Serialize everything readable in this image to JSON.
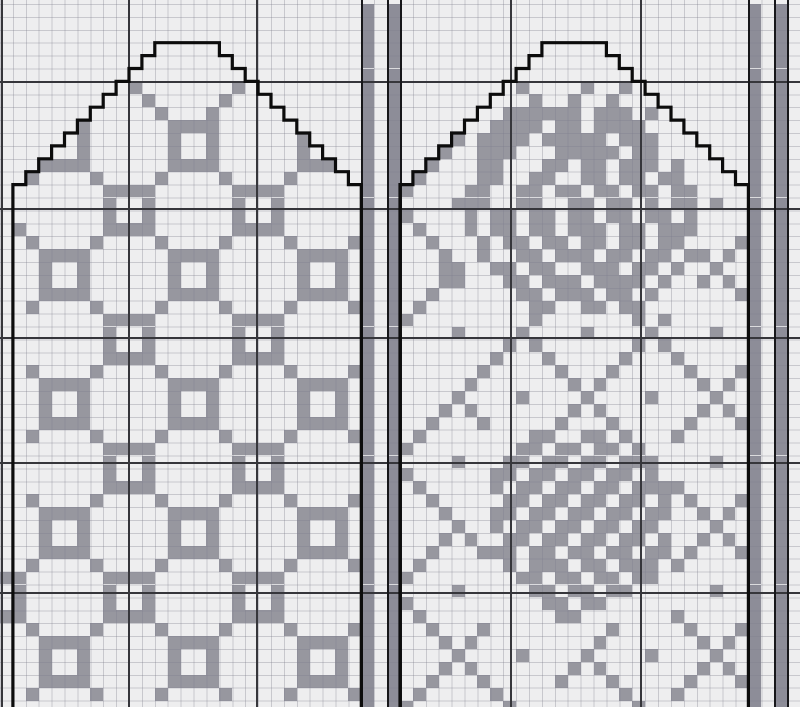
{
  "chart_data": {
    "type": "heatmap",
    "title": "Two-panel stranded-knitting mitten chart (trellis-ring motif panel and rose motif panel) with steek bands",
    "grid_columns": 62,
    "grid_rows": 55,
    "cell_glyphs": {
      "#": "pattern-stitch",
      "b": "steek-band-stitch",
      ".": "background-stitch"
    },
    "colors": {
      "background": "#eeeeef",
      "stitch": "#97979f",
      "band_stitch": "#8d8d98",
      "major_gridline": "#36363b",
      "band_line": "#17171a",
      "outline": "#0c0c0c"
    },
    "mittens": [
      {
        "name": "left-mitten-trellis-panel",
        "left_col": 1,
        "right_col": 28,
        "top_row": 3,
        "flat_start_col": 12,
        "flat_end_col": 17,
        "base_row": 14
      },
      {
        "name": "right-mitten-rose-panel",
        "left_col": 31,
        "right_col": 58,
        "top_row": 3,
        "flat_start_col": 42,
        "flat_end_col": 47,
        "base_row": 14
      }
    ],
    "steek_bands": [
      {
        "gray_cols": [
          28,
          30
        ],
        "line_cols": [
          28,
          30,
          31
        ]
      },
      {
        "gray_cols": [
          58,
          60
        ],
        "line_cols": [
          58,
          60,
          61
        ]
      }
    ],
    "major_gridlines": {
      "x_px": [
        1,
        128,
        256,
        510,
        640
      ],
      "y_px": [
        81,
        208,
        337,
        462,
        592
      ]
    },
    "grid": [
      "............................b.b...........................b.b.",
      "............................b.b...........................b.b.",
      "............................b.b...........................b.b.",
      "............................b.b...........................b.b.",
      "............................b.b...........................b.b.",
      "............................b.b...........................b.b.",
      "..........#.......#.........b.b.........#....#..#.........b.b.",
      "...........#.....#..........b.b..........#..#..#..........b.b.",
      "............#...#...........b.b........######.###.#.......b.b.",
      "......#......####...........b.b.......####.##.####........b.b.",
      "......#......#..#......#....b.b....#.####.#####.###.......b.b.",
      "......#......#..#......#....b.b...#..###...#####.##.......b.b.",
      "...####......####......###..b.b..#...##...##.##.###.#.....b.b.",
      "..#....#....#....#....#.....b.b.#....##..##..##.##.##.....b.b.",
      "........####......####......b.b#....##..##.##.##.##.##....b.b.",
      "........#..#......#..#......b.b....###..##..##.##.#.##.#..b.b.",
      "........#..#......#..#......b.b#....#.##.##.##.##.##.#....b.b.",
      ".#......####......####......b.b.#...#.##.##.###.##.###....b.b.",
      "..#....#....#....#....#....#b.b..#...#.##.##.##.##.##....#b.b.",
      "...####......####......####.b.b...#..#..##.###.##.##.##.#.b.b.",
      "...#..#......#..#......#..#.b.b...##..##.##..###.##.#..#..b.b.",
      "...#..#......#..#......#..#.b.b...##...##.###.####.#..#.#.b.b.",
      "...####......####......####.b.b..#......##.###.##.#......#b.b.",
      "..#....#....#....#....#....#b.b.#........##..##.##........b.b.",
      "........####......####......b.b#.........#.......#.#......b.b.",
      "........#..#......#..#......b.b....#....#....#....#....#..b.b.",
      "........#..#......#..#......b.b........#.#.......#.#......b.b.",
      "........####......####......b.b.......#...#.....#...#.....b.b.",
      "..#....#....#....#....#....#b.b......#.....#...#.....#...#b.b.",
      "...####......####......####.b.b.....#.......#.#.......#.#.b.b.",
      "...#..#......#..#......#..#.b.b....#....#....#....#....#..b.b.",
      "...#..#......#..#......#..#.b.b...#.#.......#.#.......#.#.b.b.",
      "...####......####......####.b.b..#...#.....#...#.....#...#b.b.",
      "..#....#....#....#....#....#b.b.#........##..##.#...#.....b.b.",
      "........####......####......b.b#........##.##.##.#........b.b.",
      "........#..#......#..#......b.b....#...##.##.##.###....#..b.b.",
      "........#..#......#..#......b.b#......##.##.##.##.#.......b.b.",
      "........####......####......b.b.#.....#.##.##.##.####.....b.b.",
      "..#....#....#....#....#....#b.b..#.....##.##.##.##.#.#...#b.b.",
      "...####......####......####.b.b...#...##.##.##.##.##..#.#.b.b.",
      "...#..#......#..#......#..#.b.b....#..#.##.##.##.##....#..b.b.",
      "...#..#......#..#......#..#.b.b...#.#..##.##.##.##.#..#.#.b.b.",
      "...####......####......####.b.b..#...###.##.##.##.##.#...#b.b.",
      "..#....#....#....#....#....#b.b.#......#.###.##.###.#.....b.b.",
      "##......####......####......b.b#........##.##.##.##.......b.b.",
      ".#......#..#......#..#......b.b....#.....##.##.##......#..b.b.",
      ".#......#..#......#..#......b.b#..........##.##...........b.b.",
      "##......####......####......b.b.#..........##.......#.....b.b.",
      "..#....#....#....#....#....#b.b..#...#.........#.....#...#b.b.",
      "...####......####......####.b.b...#.#.........#.......#.#.b.b.",
      "...#..#......#..#......#..#.b.b....#....#....#....#....#..b.b.",
      "...#..#......#..#......#..#.b.b...#.#.......#.#.......#.#.b.b.",
      "...####......####......####.b.b..#...#.....#...#.....#...#b.b.",
      "..#....#....#....#....#....#b.b.#.....#.........#...#.....b.b.",
      "............................b.b#.......#.........#........b.b."
    ]
  }
}
